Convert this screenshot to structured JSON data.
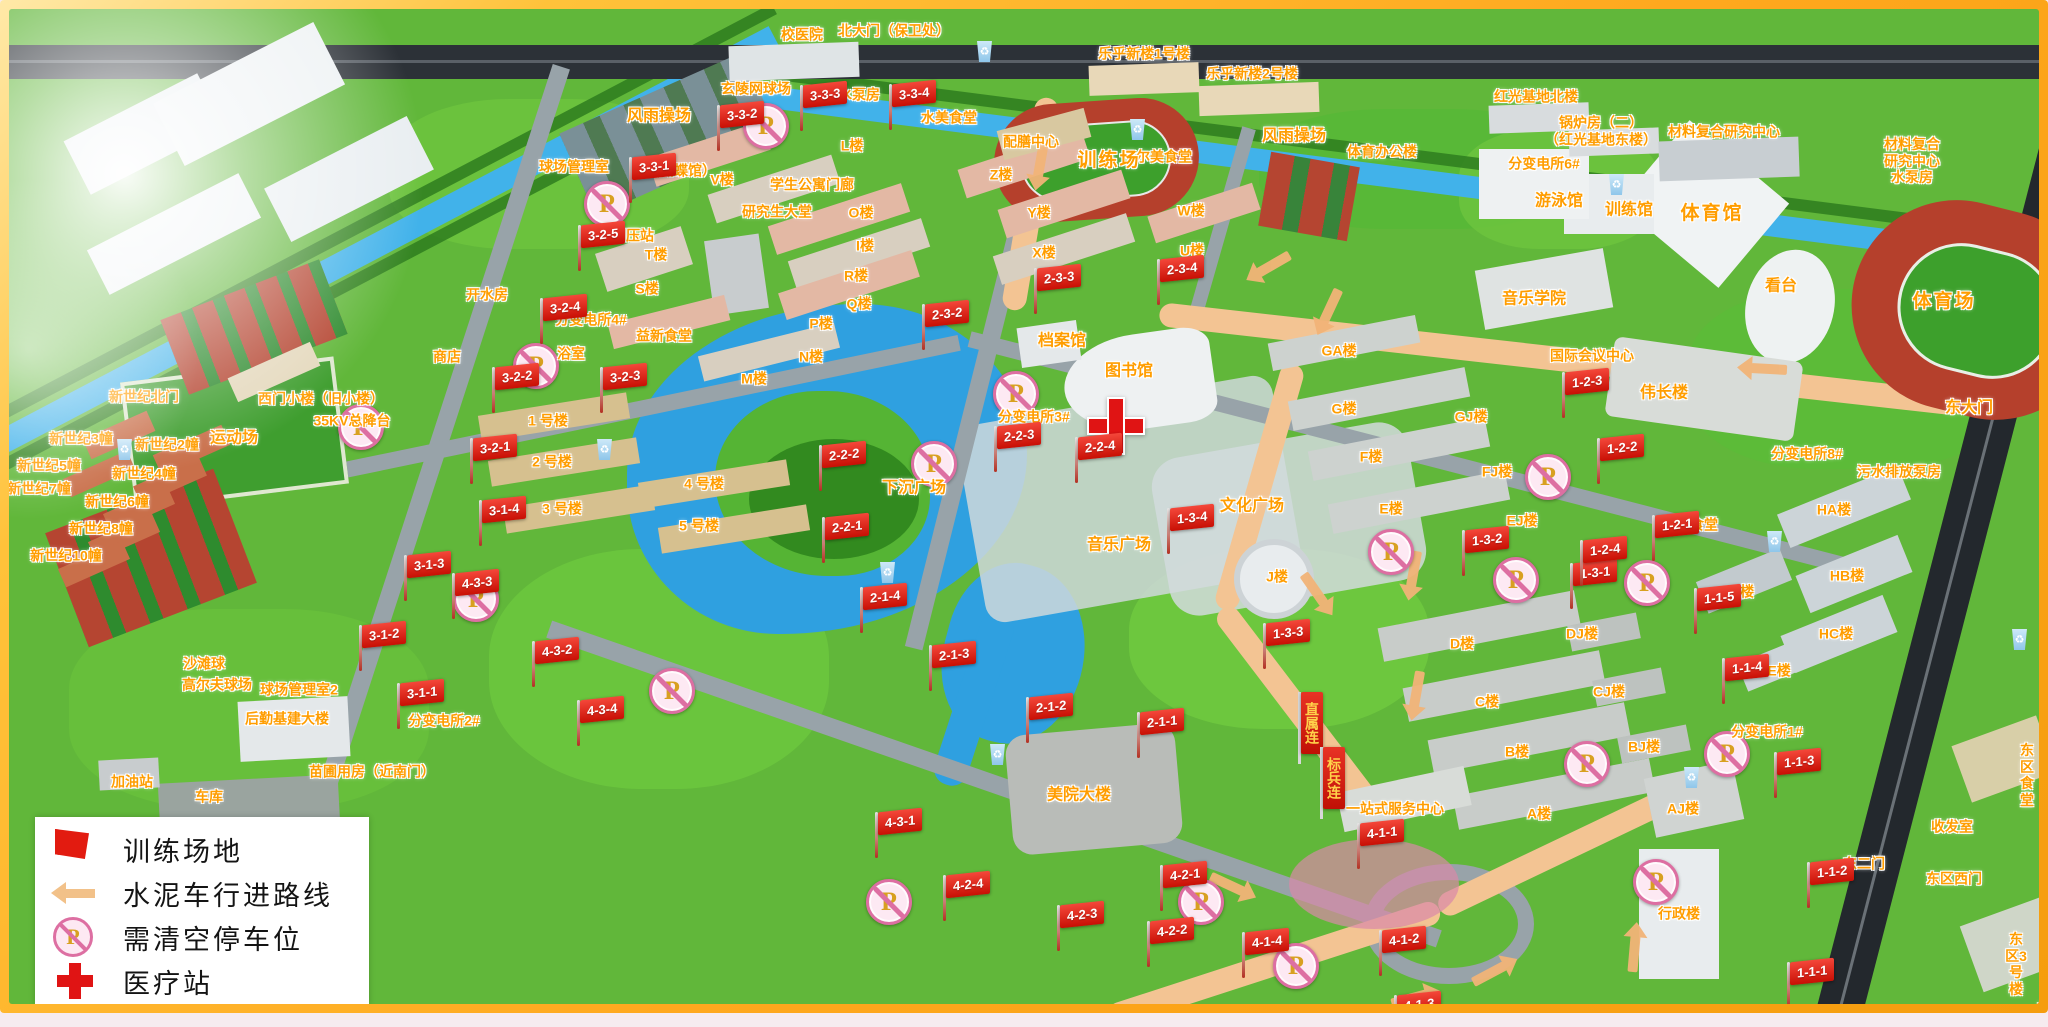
{
  "legend": {
    "items": [
      {
        "icon": "training-flag-icon",
        "label": "训练场地"
      },
      {
        "icon": "route-arrow-icon",
        "label": "水泥车行进路线"
      },
      {
        "icon": "no-parking-icon",
        "label": "需清空停车位"
      },
      {
        "icon": "medical-cross-icon",
        "label": "医疗站"
      }
    ]
  },
  "map": {
    "colors": {
      "flag_red": "#d81e0f",
      "label_orange": "#ff9d00",
      "route_tan": "#f2b478",
      "no_parking_pink": "#dd6fa2",
      "water_blue": "#2fa0e0",
      "medical_red": "#e01414",
      "track_red": "#b5402c",
      "field_green": "#3da02c"
    },
    "place_labels": [
      {
        "t": "校医院",
        "x": 793,
        "y": 26
      },
      {
        "t": "北大门（保卫处）",
        "x": 885,
        "y": 22
      },
      {
        "t": "乐乎新楼1号楼",
        "x": 1135,
        "y": 45
      },
      {
        "t": "乐乎新楼2号楼",
        "x": 1243,
        "y": 65
      },
      {
        "t": "红光基地北楼",
        "x": 1527,
        "y": 88
      },
      {
        "t": "锅炉房（二）\n（红光基地东楼）",
        "x": 1592,
        "y": 122
      },
      {
        "t": "材料复合研究中心",
        "x": 1715,
        "y": 123
      },
      {
        "t": "材料复合\n研究中心\n水泵房",
        "x": 1903,
        "y": 152
      },
      {
        "t": "风雨操场",
        "x": 650,
        "y": 108,
        "s": 2
      },
      {
        "t": "玄陵网球场",
        "x": 747,
        "y": 80
      },
      {
        "t": "雨水泵房",
        "x": 843,
        "y": 86
      },
      {
        "t": "2#",
        "x": 906,
        "y": 85,
        "s": 1
      },
      {
        "t": "球场管理室",
        "x": 565,
        "y": 158
      },
      {
        "t": "（蝴蝶馆）",
        "x": 672,
        "y": 162
      },
      {
        "t": "V楼",
        "x": 713,
        "y": 171
      },
      {
        "t": "学生公寓门廊",
        "x": 803,
        "y": 176
      },
      {
        "t": "研究生大堂",
        "x": 768,
        "y": 203
      },
      {
        "t": "L楼",
        "x": 843,
        "y": 137
      },
      {
        "t": "配膳中心",
        "x": 1022,
        "y": 133
      },
      {
        "t": "水美食堂",
        "x": 940,
        "y": 109
      },
      {
        "t": "尔美食堂",
        "x": 1155,
        "y": 148
      },
      {
        "t": "风雨操场",
        "x": 1285,
        "y": 128,
        "s": 2
      },
      {
        "t": "体育办公楼",
        "x": 1373,
        "y": 143
      },
      {
        "t": "训练场",
        "x": 1100,
        "y": 152,
        "s": 3
      },
      {
        "t": "分变电所6#",
        "x": 1535,
        "y": 155
      },
      {
        "t": "游泳馆",
        "x": 1550,
        "y": 193,
        "s": 2
      },
      {
        "t": "训练馆",
        "x": 1620,
        "y": 202,
        "s": 2
      },
      {
        "t": "体育馆",
        "x": 1703,
        "y": 205,
        "s": 3
      },
      {
        "t": "看台",
        "x": 1772,
        "y": 278,
        "s": 2
      },
      {
        "t": "体育场",
        "x": 1935,
        "y": 293,
        "s": 3
      },
      {
        "t": "音乐学院",
        "x": 1525,
        "y": 291,
        "s": 2
      },
      {
        "t": "Z楼",
        "x": 992,
        "y": 166
      },
      {
        "t": "Y楼",
        "x": 1030,
        "y": 204
      },
      {
        "t": "X楼",
        "x": 1035,
        "y": 244
      },
      {
        "t": "W楼",
        "x": 1182,
        "y": 202
      },
      {
        "t": "U楼",
        "x": 1183,
        "y": 242
      },
      {
        "t": "O楼",
        "x": 852,
        "y": 204
      },
      {
        "t": "I楼",
        "x": 856,
        "y": 237
      },
      {
        "t": "R楼",
        "x": 847,
        "y": 267
      },
      {
        "t": "Q楼",
        "x": 850,
        "y": 295
      },
      {
        "t": "P楼",
        "x": 812,
        "y": 315
      },
      {
        "t": "N楼",
        "x": 802,
        "y": 348
      },
      {
        "t": "M楼",
        "x": 745,
        "y": 370
      },
      {
        "t": "T楼",
        "x": 647,
        "y": 246
      },
      {
        "t": "S楼",
        "x": 638,
        "y": 280
      },
      {
        "t": "开水房",
        "x": 478,
        "y": 286
      },
      {
        "t": "燃气调压站",
        "x": 610,
        "y": 227
      },
      {
        "t": "分变电所4#",
        "x": 582,
        "y": 311
      },
      {
        "t": "益新食堂",
        "x": 655,
        "y": 327
      },
      {
        "t": "商店",
        "x": 438,
        "y": 348
      },
      {
        "t": "浴室",
        "x": 562,
        "y": 345
      },
      {
        "t": "1 号楼",
        "x": 539,
        "y": 412
      },
      {
        "t": "2 号楼",
        "x": 543,
        "y": 453
      },
      {
        "t": "3 号楼",
        "x": 553,
        "y": 500
      },
      {
        "t": "4 号楼",
        "x": 695,
        "y": 475
      },
      {
        "t": "5 号楼",
        "x": 690,
        "y": 517
      },
      {
        "t": "新世纪北门",
        "x": 135,
        "y": 388
      },
      {
        "t": "西门小楼（旧小楼）",
        "x": 312,
        "y": 390
      },
      {
        "t": "35KV总降台",
        "x": 343,
        "y": 412
      },
      {
        "t": "新世纪3幢",
        "x": 72,
        "y": 430
      },
      {
        "t": "新世纪2幢",
        "x": 158,
        "y": 436
      },
      {
        "t": "新世纪5幢",
        "x": 40,
        "y": 457
      },
      {
        "t": "新世纪4幢",
        "x": 135,
        "y": 465
      },
      {
        "t": "新世纪7幢",
        "x": 30,
        "y": 480
      },
      {
        "t": "新世纪6幢",
        "x": 108,
        "y": 493
      },
      {
        "t": "新世纪8幢",
        "x": 92,
        "y": 520
      },
      {
        "t": "新世纪10幢",
        "x": 57,
        "y": 547
      },
      {
        "t": "运动场",
        "x": 225,
        "y": 430,
        "s": 2
      },
      {
        "t": "沙滩球",
        "x": 195,
        "y": 655
      },
      {
        "t": "高尔夫球场",
        "x": 208,
        "y": 676
      },
      {
        "t": "球场管理室2",
        "x": 290,
        "y": 681
      },
      {
        "t": "后勤基建大楼",
        "x": 278,
        "y": 710
      },
      {
        "t": "分变电所2#",
        "x": 435,
        "y": 712
      },
      {
        "t": "苗圃用房（近南门）",
        "x": 363,
        "y": 763
      },
      {
        "t": "加油站",
        "x": 123,
        "y": 773
      },
      {
        "t": "车库",
        "x": 200,
        "y": 788
      },
      {
        "t": "档案馆",
        "x": 1053,
        "y": 333,
        "s": 2
      },
      {
        "t": "图书馆",
        "x": 1120,
        "y": 363,
        "s": 2
      },
      {
        "t": "分变电所3#",
        "x": 1025,
        "y": 408
      },
      {
        "t": "下沉广场",
        "x": 905,
        "y": 480,
        "s": 2
      },
      {
        "t": "文化广场",
        "x": 1243,
        "y": 498,
        "s": 2
      },
      {
        "t": "音乐广场",
        "x": 1110,
        "y": 537,
        "s": 2
      },
      {
        "t": "美院大楼",
        "x": 1070,
        "y": 787,
        "s": 2
      },
      {
        "t": "J楼",
        "x": 1268,
        "y": 568
      },
      {
        "t": "GA楼",
        "x": 1330,
        "y": 342
      },
      {
        "t": "G楼",
        "x": 1335,
        "y": 400
      },
      {
        "t": "GJ楼",
        "x": 1462,
        "y": 408
      },
      {
        "t": "F楼",
        "x": 1362,
        "y": 448
      },
      {
        "t": "FJ楼",
        "x": 1488,
        "y": 463
      },
      {
        "t": "E楼",
        "x": 1382,
        "y": 500
      },
      {
        "t": "EJ楼",
        "x": 1513,
        "y": 512
      },
      {
        "t": "国际会议中心",
        "x": 1583,
        "y": 347
      },
      {
        "t": "伟长楼",
        "x": 1655,
        "y": 385,
        "s": 2
      },
      {
        "t": "秀食堂",
        "x": 1688,
        "y": 516
      },
      {
        "t": "D楼",
        "x": 1453,
        "y": 635
      },
      {
        "t": "DJ楼",
        "x": 1573,
        "y": 625
      },
      {
        "t": "C楼",
        "x": 1478,
        "y": 693
      },
      {
        "t": "CJ楼",
        "x": 1600,
        "y": 683
      },
      {
        "t": "B楼",
        "x": 1508,
        "y": 743
      },
      {
        "t": "BJ楼",
        "x": 1635,
        "y": 738
      },
      {
        "t": "A楼",
        "x": 1530,
        "y": 805
      },
      {
        "t": "AJ楼",
        "x": 1674,
        "y": 800
      },
      {
        "t": "一站式服务中心",
        "x": 1386,
        "y": 800
      },
      {
        "t": "行政楼",
        "x": 1670,
        "y": 905
      },
      {
        "t": "东大门",
        "x": 1960,
        "y": 400,
        "s": 2
      },
      {
        "t": "分变电所8#",
        "x": 1798,
        "y": 445
      },
      {
        "t": "污水排放泵房",
        "x": 1890,
        "y": 463
      },
      {
        "t": "HA楼",
        "x": 1825,
        "y": 501
      },
      {
        "t": "HB楼",
        "x": 1838,
        "y": 567
      },
      {
        "t": "HC楼",
        "x": 1827,
        "y": 625
      },
      {
        "t": "HD楼",
        "x": 1728,
        "y": 583
      },
      {
        "t": "HE楼",
        "x": 1765,
        "y": 662
      },
      {
        "t": "分变电所1#",
        "x": 1758,
        "y": 723
      },
      {
        "t": "收发室",
        "x": 1943,
        "y": 818
      },
      {
        "t": "东二门",
        "x": 1855,
        "y": 855
      },
      {
        "t": "东区西门",
        "x": 1945,
        "y": 870
      },
      {
        "t": "东区食堂",
        "x": 2018,
        "y": 766
      },
      {
        "t": "东区3号楼",
        "x": 2007,
        "y": 955
      },
      {
        "t": "东区",
        "x": 2035,
        "y": 1008
      }
    ],
    "flags": [
      {
        "label": "3-3-1",
        "x": 622,
        "y": 162
      },
      {
        "label": "3-3-2",
        "x": 710,
        "y": 110
      },
      {
        "label": "3-3-3",
        "x": 793,
        "y": 90
      },
      {
        "label": "3-3-4",
        "x": 882,
        "y": 89
      },
      {
        "label": "3-2-5",
        "x": 571,
        "y": 230
      },
      {
        "label": "3-2-4",
        "x": 533,
        "y": 303
      },
      {
        "label": "3-2-3",
        "x": 593,
        "y": 372
      },
      {
        "label": "3-2-2",
        "x": 485,
        "y": 372
      },
      {
        "label": "3-2-1",
        "x": 463,
        "y": 443
      },
      {
        "label": "3-1-4",
        "x": 472,
        "y": 505
      },
      {
        "label": "3-1-3",
        "x": 397,
        "y": 560
      },
      {
        "label": "3-1-2",
        "x": 352,
        "y": 630
      },
      {
        "label": "3-1-1",
        "x": 390,
        "y": 688
      },
      {
        "label": "2-3-2",
        "x": 915,
        "y": 309
      },
      {
        "label": "2-3-3",
        "x": 1027,
        "y": 273
      },
      {
        "label": "2-3-4",
        "x": 1150,
        "y": 264
      },
      {
        "label": "2-2-3",
        "x": 987,
        "y": 431
      },
      {
        "label": "2-2-4",
        "x": 1068,
        "y": 442
      },
      {
        "label": "2-2-2",
        "x": 812,
        "y": 450
      },
      {
        "label": "2-2-1",
        "x": 815,
        "y": 522
      },
      {
        "label": "2-1-4",
        "x": 853,
        "y": 592
      },
      {
        "label": "2-1-3",
        "x": 922,
        "y": 650
      },
      {
        "label": "2-1-2",
        "x": 1019,
        "y": 702
      },
      {
        "label": "2-1-1",
        "x": 1130,
        "y": 717
      },
      {
        "label": "1-3-4",
        "x": 1160,
        "y": 513
      },
      {
        "label": "1-3-2",
        "x": 1455,
        "y": 535
      },
      {
        "label": "1-3-1",
        "x": 1563,
        "y": 568
      },
      {
        "label": "1-3-3",
        "x": 1256,
        "y": 628
      },
      {
        "label": "1-2-3",
        "x": 1555,
        "y": 377
      },
      {
        "label": "1-2-2",
        "x": 1590,
        "y": 443
      },
      {
        "label": "1-2-1",
        "x": 1645,
        "y": 520
      },
      {
        "label": "1-2-4",
        "x": 1573,
        "y": 545
      },
      {
        "label": "1-1-5",
        "x": 1687,
        "y": 593
      },
      {
        "label": "1-1-4",
        "x": 1715,
        "y": 663
      },
      {
        "label": "1-1-3",
        "x": 1767,
        "y": 757
      },
      {
        "label": "1-1-2",
        "x": 1800,
        "y": 867
      },
      {
        "label": "1-1-1",
        "x": 1780,
        "y": 967
      },
      {
        "label": "4-3-4",
        "x": 570,
        "y": 705
      },
      {
        "label": "4-3-3",
        "x": 445,
        "y": 578
      },
      {
        "label": "4-3-2",
        "x": 525,
        "y": 646
      },
      {
        "label": "4-3-1",
        "x": 868,
        "y": 817
      },
      {
        "label": "4-2-4",
        "x": 936,
        "y": 880
      },
      {
        "label": "4-2-3",
        "x": 1050,
        "y": 910
      },
      {
        "label": "4-2-2",
        "x": 1140,
        "y": 926
      },
      {
        "label": "4-2-1",
        "x": 1153,
        "y": 870
      },
      {
        "label": "4-1-4",
        "x": 1235,
        "y": 937
      },
      {
        "label": "4-1-1",
        "x": 1350,
        "y": 828
      },
      {
        "label": "4-1-2",
        "x": 1372,
        "y": 935
      },
      {
        "label": "4-1-3",
        "x": 1387,
        "y": 1000
      }
    ],
    "banner_flags": [
      {
        "label": "直属连",
        "x": 1292,
        "y": 689
      },
      {
        "label": "标兵连",
        "x": 1314,
        "y": 744
      }
    ],
    "no_parking": [
      {
        "x": 757,
        "y": 117
      },
      {
        "x": 598,
        "y": 195
      },
      {
        "x": 527,
        "y": 357
      },
      {
        "x": 352,
        "y": 418
      },
      {
        "x": 467,
        "y": 590
      },
      {
        "x": 663,
        "y": 682
      },
      {
        "x": 925,
        "y": 455
      },
      {
        "x": 1007,
        "y": 385
      },
      {
        "x": 1539,
        "y": 468
      },
      {
        "x": 1382,
        "y": 543
      },
      {
        "x": 1507,
        "y": 571
      },
      {
        "x": 1638,
        "y": 574
      },
      {
        "x": 1718,
        "y": 745
      },
      {
        "x": 1578,
        "y": 755
      },
      {
        "x": 1647,
        "y": 873
      },
      {
        "x": 880,
        "y": 893
      },
      {
        "x": 1192,
        "y": 893
      },
      {
        "x": 1287,
        "y": 957
      }
    ],
    "medical_stations": [
      {
        "x": 1107,
        "y": 417
      }
    ],
    "recycle_bins": [
      {
        "x": 975,
        "y": 42
      },
      {
        "x": 1128,
        "y": 120
      },
      {
        "x": 1607,
        "y": 175
      },
      {
        "x": 595,
        "y": 440
      },
      {
        "x": 988,
        "y": 745
      },
      {
        "x": 1682,
        "y": 768
      },
      {
        "x": 1765,
        "y": 532
      },
      {
        "x": 2010,
        "y": 630
      },
      {
        "x": 115,
        "y": 440
      },
      {
        "x": 878,
        "y": 563
      }
    ],
    "route_arrows": [
      {
        "x": 1032,
        "y": 150,
        "r": 100
      },
      {
        "x": 1265,
        "y": 255,
        "r": 150
      },
      {
        "x": 1322,
        "y": 297,
        "r": 115
      },
      {
        "x": 1405,
        "y": 560,
        "r": 100
      },
      {
        "x": 1408,
        "y": 680,
        "r": 100
      },
      {
        "x": 1305,
        "y": 580,
        "r": 55
      },
      {
        "x": 1625,
        "y": 945,
        "r": -85
      },
      {
        "x": 1480,
        "y": 965,
        "r": -28
      },
      {
        "x": 1400,
        "y": 990,
        "r": -15
      },
      {
        "x": 1760,
        "y": 360,
        "r": 183
      },
      {
        "x": 1218,
        "y": 875,
        "r": 25
      }
    ]
  }
}
